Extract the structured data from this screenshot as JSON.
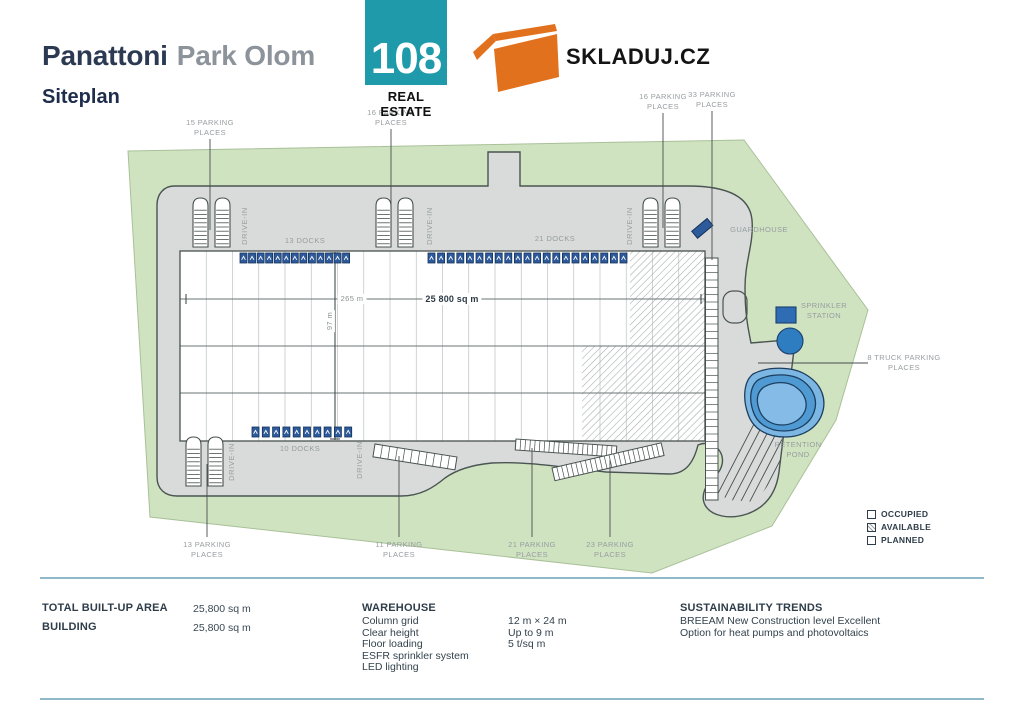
{
  "header": {
    "title_primary": "Panattoni",
    "title_secondary": "Park Olom",
    "subtitle": "Siteplan",
    "logo_number": "108",
    "logo_caption": "REAL ESTATE",
    "brand_text": "SKLADUJ.CZ"
  },
  "plan": {
    "drive_in": "DRIVE-IN",
    "dims": {
      "width": "265 m",
      "height": "97 m",
      "area": "25 800 sq m"
    },
    "docks": [
      {
        "id": "top-left",
        "label": "13 DOCKS",
        "count": 13
      },
      {
        "id": "top-right",
        "label": "21 DOCKS",
        "count": 21
      },
      {
        "id": "bottom",
        "label": "10 DOCKS",
        "count": 10
      }
    ],
    "parking": [
      {
        "id": "top-1",
        "line1": "15 PARKING",
        "line2": "PLACES",
        "count": 15
      },
      {
        "id": "top-2",
        "line1": "16 PARKING",
        "line2": "PLACES",
        "count": 16
      },
      {
        "id": "top-3",
        "line1": "16 PARKING",
        "line2": "PLACES",
        "count": 16
      },
      {
        "id": "top-4",
        "line1": "33 PARKING",
        "line2": "PLACES",
        "count": 33
      },
      {
        "id": "bottom-1",
        "line1": "13 PARKING",
        "line2": "PLACES",
        "count": 13
      },
      {
        "id": "bottom-2",
        "line1": "11 PARKING",
        "line2": "PLACES",
        "count": 11
      },
      {
        "id": "bottom-3",
        "line1": "21 PARKING",
        "line2": "PLACES",
        "count": 21
      },
      {
        "id": "bottom-4",
        "line1": "23 PARKING",
        "line2": "PLACES",
        "count": 23
      },
      {
        "id": "truck",
        "line1": "8 TRUCK PARKING",
        "line2": "PLACES",
        "count": 8
      }
    ],
    "poi": {
      "guardhouse": "GUARDHOUSE",
      "sprinkler_l1": "SPRINKLER",
      "sprinkler_l2": "STATION",
      "retention_l1": "RETENTION",
      "retention_l2": "POND"
    }
  },
  "legend": {
    "items": [
      {
        "label": "OCCUPIED",
        "style": "occupied"
      },
      {
        "label": "AVAILABLE",
        "style": "available"
      },
      {
        "label": "PLANNED",
        "style": "planned"
      }
    ]
  },
  "specs": {
    "left": [
      {
        "label": "TOTAL BUILT-UP AREA",
        "value": "25,800 sq m"
      },
      {
        "label": "BUILDING",
        "value": "25,800 sq m"
      }
    ],
    "warehouse": {
      "title": "WAREHOUSE",
      "rows": [
        {
          "label": "Column grid",
          "value": "12 m × 24 m"
        },
        {
          "label": "Clear height",
          "value": "Up to 9 m"
        },
        {
          "label": "Floor loading",
          "value": "5 t/sq m"
        },
        {
          "label": "ESFR sprinkler system",
          "value": ""
        },
        {
          "label": "LED lighting",
          "value": ""
        }
      ]
    },
    "sustainability": {
      "title": "SUSTAINABILITY TRENDS",
      "lines": [
        "BREEAM New Construction level Excellent",
        "Option for heat pumps and photovoltaics"
      ]
    }
  },
  "colors": {
    "accent_teal": "#1e9aaa",
    "brand_orange": "#e2711d",
    "dock_blue": "#2d5a9b",
    "site_green": "#cfe3c1",
    "road_gray": "#d8dbd9",
    "pond_blue": "#7cb7e3",
    "divider_blue": "#8fb9ca"
  }
}
